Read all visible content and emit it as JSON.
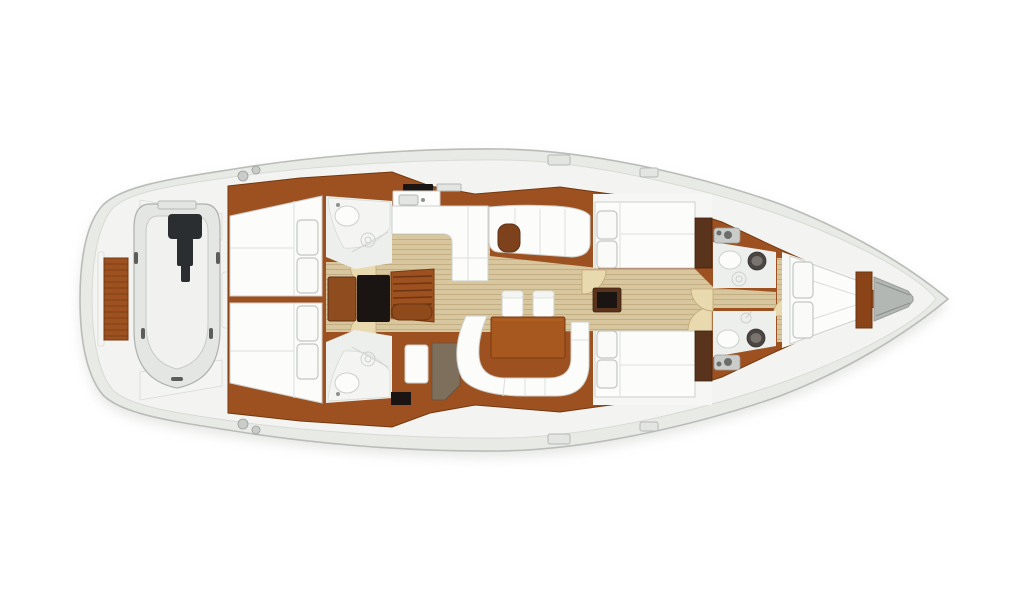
{
  "diagram": {
    "type": "yacht-interior-floorplan",
    "label": "Sailing yacht interior layout plan, top view, bow pointing right",
    "orientation": "bow-right"
  },
  "colors": {
    "background": "#ffffff",
    "hull_fill": "#e8eae6",
    "hull_stroke": "#b9bcb7",
    "deck_fill": "#f3f4f1",
    "deck_stroke": "#d8dad5",
    "shadow": "#d4d6d2",
    "wood": "#9e5120",
    "wood_dark": "#74380f",
    "walnut": "#59331c",
    "black_panel": "#1a1512",
    "taupe": "#7e6f5c",
    "floor": "#d8c69e",
    "floor_stripe": "#c3ae83",
    "floor_arc": "#e8d9ae",
    "floor_arc_stroke": "#c2a878",
    "white_furniture": "#fcfdfb",
    "furniture_stroke": "#cdd0cb",
    "mattress_seam": "#dcdedb",
    "fixture_gray": "#e3e5e2",
    "toilet_dark": "#4b4643",
    "dinghy_tube": "#e4e6e3",
    "dinghy_stroke": "#aeb1ad",
    "motor_dark": "#2b2e30",
    "fitting_gray": "#c9ccc8"
  },
  "inventory": {
    "rooms": [
      "tender-garage",
      "aft-cabin-port",
      "aft-cabin-starboard",
      "aft-head-port",
      "aft-head-starboard",
      "galley",
      "salon",
      "mid-cabin-port",
      "mid-cabin-starboard",
      "forward-head-port",
      "forward-head-starboard",
      "bow-cabin",
      "anchor-locker"
    ],
    "furniture": [
      "swim-platform",
      "dinghy-with-outboard",
      "cockpit-benches",
      "companionway-stairs",
      "chart-desk",
      "engine-box",
      "galley-counters",
      "stove",
      "galley-sink",
      "longitudinal-settee",
      "dining-table",
      "stools",
      "c-shaped-settee",
      "double-berths",
      "pillows",
      "wardrobes",
      "washbasins",
      "toilets",
      "shower-drains",
      "deck-winches",
      "deck-hatches"
    ]
  }
}
